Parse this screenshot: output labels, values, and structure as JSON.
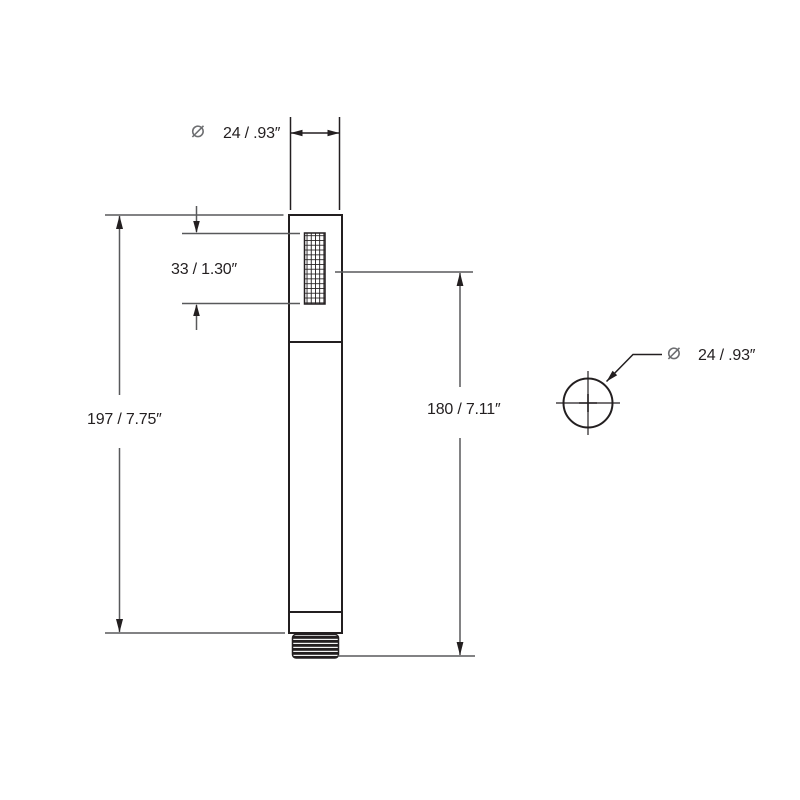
{
  "drawing": {
    "type": "technical-dimension-drawing",
    "views": {
      "front_view": "hand-shower-profile",
      "top_view": "outlet-circle"
    }
  },
  "labels": {
    "top_diameter_symbol": "⌀",
    "top_diameter": "24 / .93″",
    "spray_face_length": "33 / 1.30″",
    "overall_length": "197 / 7.75″",
    "spray_center_to_outlet": "180 / 7.11″",
    "side_diameter_symbol": "⌀",
    "side_diameter": "24 / .93″"
  },
  "dimensions_data": {
    "diameter_mm": 24,
    "diameter_in": 0.93,
    "spray_face_mm": 33,
    "spray_face_in": 1.3,
    "overall_mm": 197,
    "overall_in": 7.75,
    "spray_to_outlet_mm": 180,
    "spray_to_outlet_in": 7.11
  },
  "colors": {
    "object_line": "#231f20",
    "dimension_line": "#58595b",
    "symbol_gray": "#6d6e71",
    "text_color": "#231f20",
    "background": "#ffffff"
  }
}
